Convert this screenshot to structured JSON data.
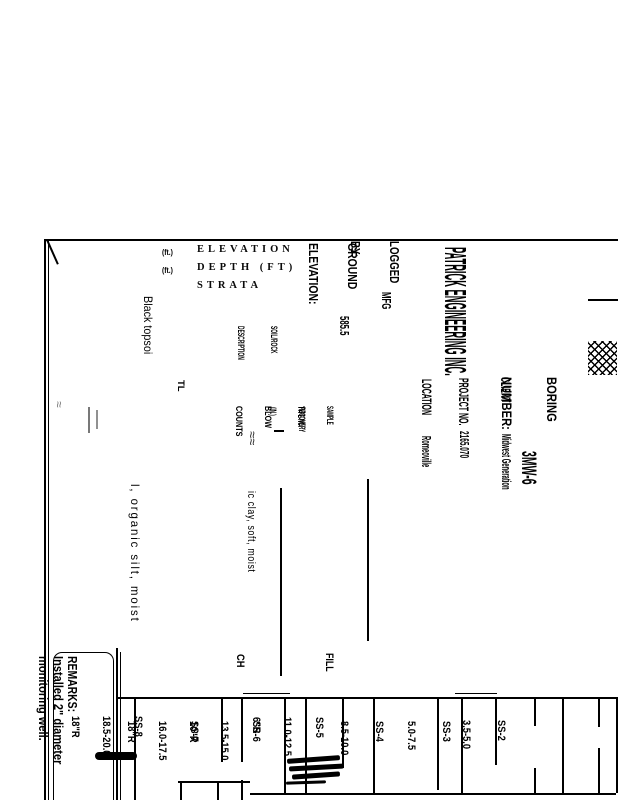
{
  "page": {
    "background": "#ffffff",
    "ink": "#000000"
  },
  "header": {
    "company": "PATRICK ENGINEERING INC.",
    "boring_label_1": "BORING",
    "boring_label_2": "NUMBER:",
    "boring_value": "3MW-6",
    "client_label": "CLIENT",
    "client_value": "Midwest Generation",
    "project_label": "PROJECT NO.",
    "project_value": "2165.070",
    "location_label": "LOCATION",
    "location_value": "Romeoville",
    "logged_label_1": "LOGGED",
    "logged_label_2": "BY:",
    "logged_value": "MFG",
    "ground_label_1": "GROUND",
    "ground_label_2": "ELEVATION:",
    "ground_value": "585.5"
  },
  "columns": {
    "elevation": "ELEVATION",
    "elevation_unit": "(ft.)",
    "depth": "DEPTH (FT)",
    "depth_unit": "(ft.)",
    "strata": "STRATA",
    "soil_rock_1": "SOIL/ROCK",
    "soil_rock_2": "DESCRIPTION",
    "sample_1": "SAMPLE",
    "sample_2": "TYPE NO.",
    "recovery_1": "RECOVERY",
    "recovery_2": "(IN.)",
    "blows_1": "BLOW",
    "blows_2": "COUNTS"
  },
  "log": {
    "stratum_note": "TL",
    "desc_line_1": "Black topsoi",
    "desc_line_2": "l, organic silt, moist",
    "desc_line_3": "ic clay, soft, moist",
    "uscs_fill": "FILL",
    "uscs_ch": "CH"
  },
  "samples": [
    {
      "id": "SS-2",
      "depth": "3.5-5.0",
      "recovery": ""
    },
    {
      "id": "SS-3",
      "depth": "5.0-7.5",
      "recovery": ""
    },
    {
      "id": "SS-4",
      "depth": "8.5-10.0",
      "recovery": ""
    },
    {
      "id": "SS-5",
      "depth": "11.0-12.5",
      "recovery": "6\"R"
    },
    {
      "id": "SS-6",
      "depth": "13.5-15.0",
      "recovery": "10\"R"
    },
    {
      "id": "SS-7",
      "depth": "16.0-17.5",
      "recovery": "18\"R"
    },
    {
      "id": "SS-8",
      "depth": "18.5-20.0",
      "recovery": "18\"R"
    }
  ],
  "remarks": {
    "label": "REMARKS:",
    "line_1": "Installed 2\" diameter",
    "line_2": "monitoring well."
  }
}
